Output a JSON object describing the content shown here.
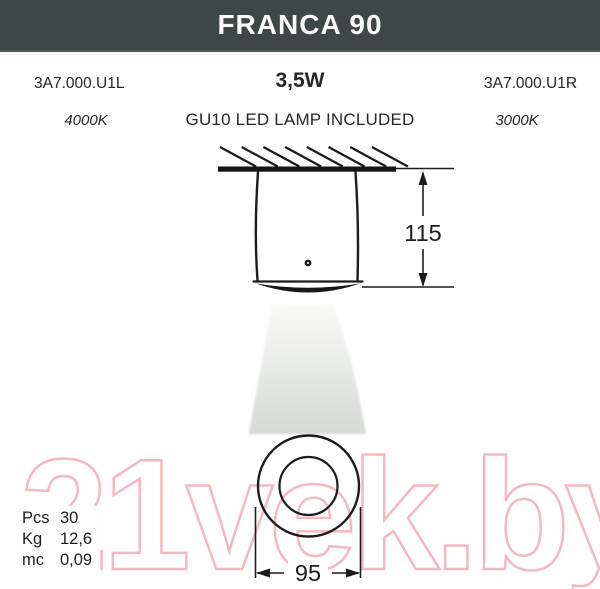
{
  "header": {
    "title": "FRANCA 90",
    "bg_color": "#3c4746"
  },
  "product": {
    "code_left": "3A7.000.U1L",
    "code_right": "3A7.000.U1R",
    "wattage": "3,5W",
    "lamp": "GU10 LED LAMP INCLUDED",
    "temp_left": "4000K",
    "temp_right": "3000K"
  },
  "drawing": {
    "height_dim": "115",
    "diameter_dim": "95"
  },
  "specs": {
    "rows": [
      {
        "label": "Pcs",
        "value": "30"
      },
      {
        "label": "Kg",
        "value": "12,6"
      },
      {
        "label": "mc",
        "value": "0,09"
      }
    ]
  },
  "watermark": {
    "text": "21vek.by",
    "color": "#f4b8c1"
  }
}
